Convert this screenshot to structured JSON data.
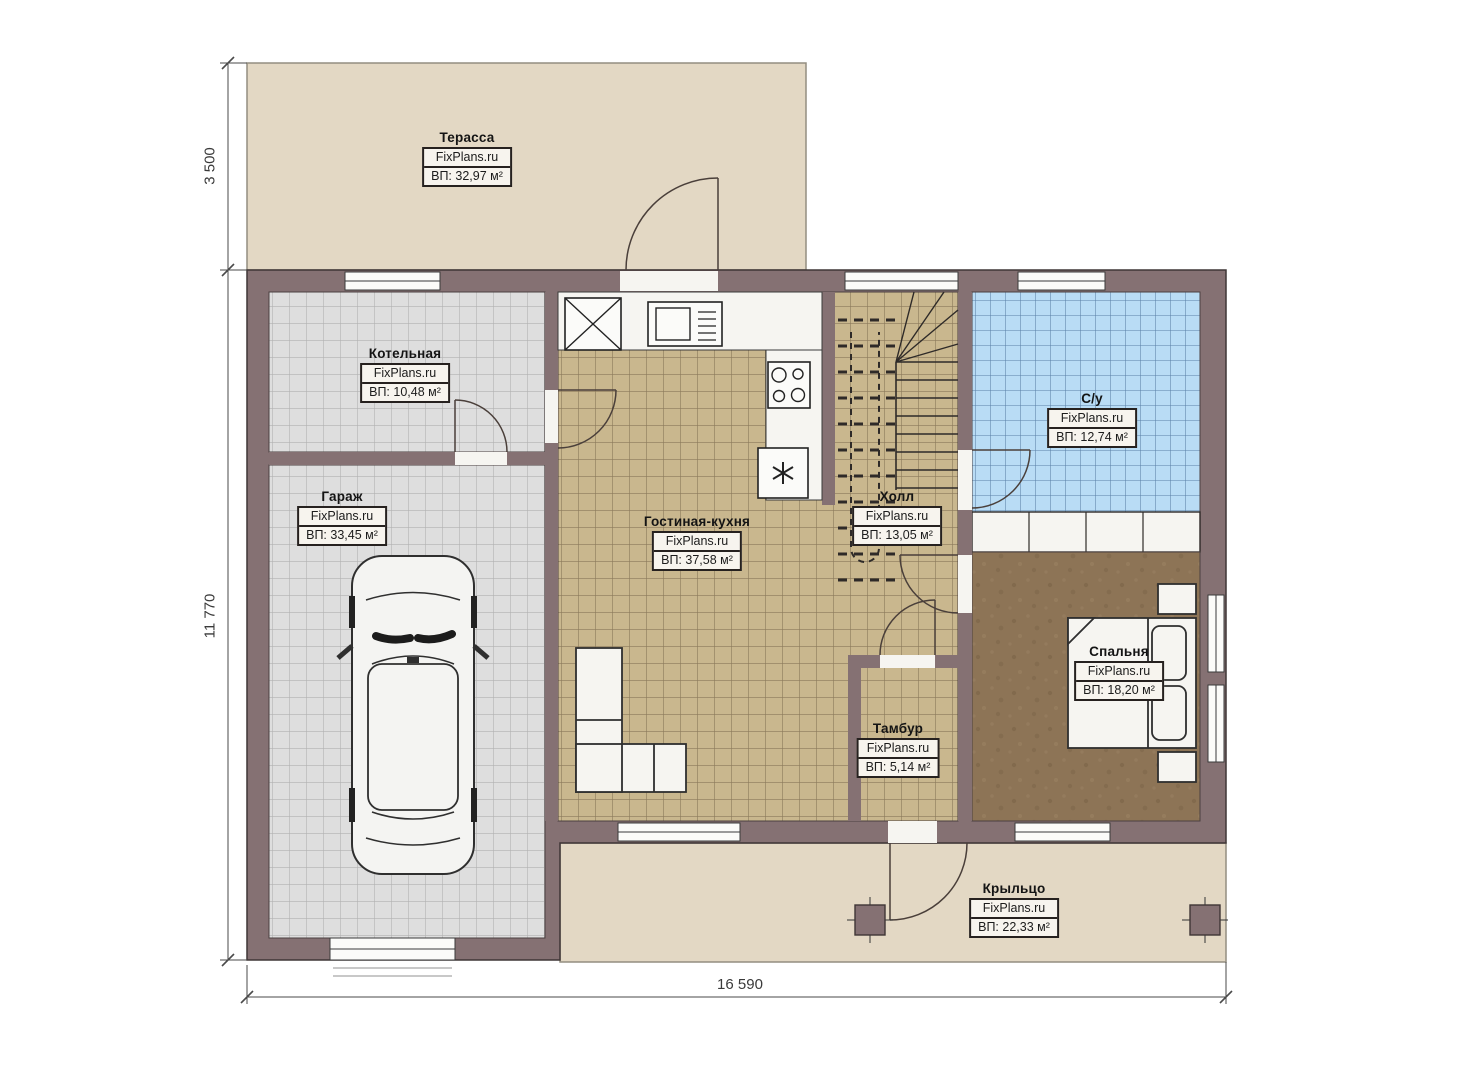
{
  "plan": {
    "brand": "FixPlans.ru",
    "rooms": {
      "terrace": {
        "name": "Терасса",
        "area": "ВП: 32,97 м²"
      },
      "boiler": {
        "name": "Котельная",
        "area": "ВП: 10,48 м²"
      },
      "garage": {
        "name": "Гараж",
        "area": "ВП: 33,45 м²"
      },
      "living_kitchen": {
        "name": "Гостиная-кухня",
        "area": "ВП: 37,58 м²"
      },
      "hall": {
        "name": "Холл",
        "area": "ВП: 13,05 м²"
      },
      "bathroom": {
        "name": "С/у",
        "area": "ВП: 12,74 м²"
      },
      "bedroom": {
        "name": "Спальня",
        "area": "ВП: 18,20 м²"
      },
      "vestibule": {
        "name": "Тамбур",
        "area": "ВП: 5,14 м²"
      },
      "porch": {
        "name": "Крыльцо",
        "area": "ВП: 22,33 м²"
      }
    },
    "dimensions": {
      "left_top": "3 500",
      "left_side": "11 770",
      "bottom": "16 590"
    },
    "colors": {
      "wall": "#857173",
      "terrace_fill": "#e3d8c4",
      "gray_tile": "#dedede",
      "tan_tile": "#c9b78e",
      "blue_tile": "#b9dcf5",
      "carpet": "#8d7456"
    }
  }
}
